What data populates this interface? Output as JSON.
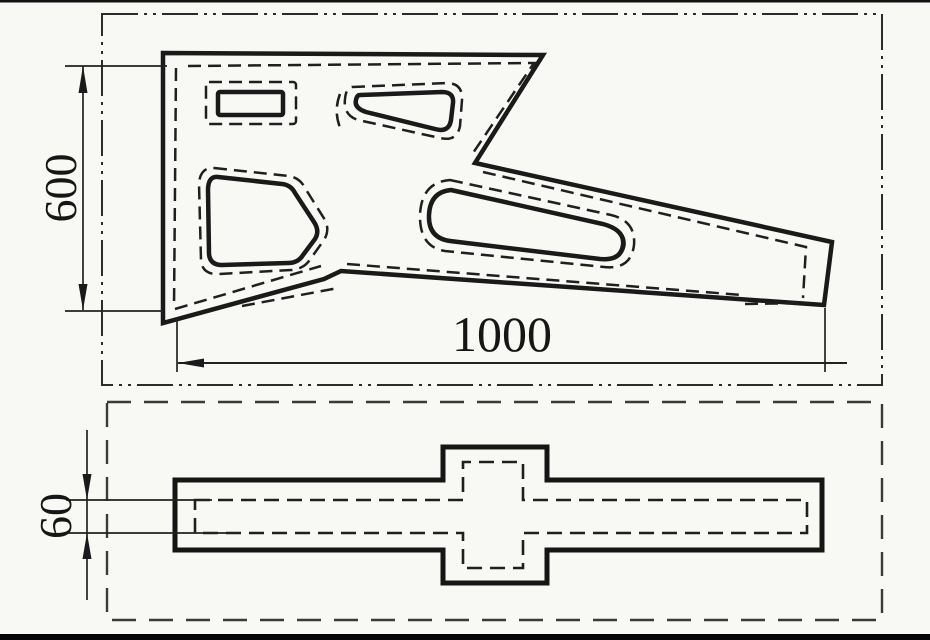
{
  "drawing": {
    "dimensions": {
      "height": {
        "label": "600",
        "orientation": "vertical"
      },
      "length": {
        "label": "1000",
        "orientation": "horizontal"
      },
      "thickness": {
        "label": "60",
        "orientation": "vertical"
      }
    },
    "colors": {
      "background": "#f8f8f5",
      "line": "#1a1a1a",
      "chain_frame": "#2b2b2b",
      "dashed_frame": "#3a3a3a"
    }
  }
}
